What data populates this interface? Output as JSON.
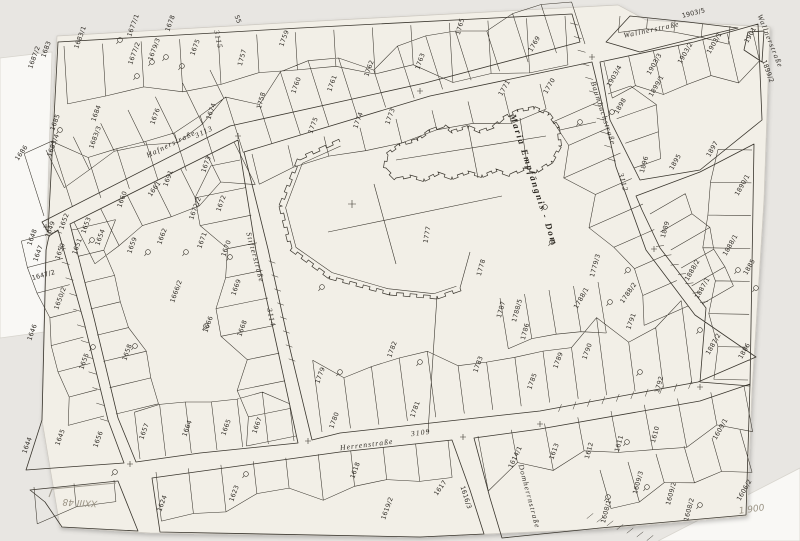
{
  "map": {
    "title": "Katastralmappe – Maria Empfängnis - Dom",
    "dom_label": "Maria Empfängnis - Dom",
    "ink_color": "#3a362e",
    "paper_color": "#f2efe7",
    "backdrop_color": "#e8e6e2",
    "under_sheet_color": "#f9f8f5",
    "streets": [
      {
        "t": "Hafnerstraße",
        "x": 172,
        "y": 146,
        "r": -26
      },
      {
        "t": "3113",
        "x": 205,
        "y": 134,
        "r": -26
      },
      {
        "t": "Stifterstraße",
        "x": 253,
        "y": 258,
        "r": 75
      },
      {
        "t": "3114",
        "x": 269,
        "y": 318,
        "r": 77
      },
      {
        "t": "Herrenstraße",
        "x": 367,
        "y": 447,
        "r": -7
      },
      {
        "t": "3109",
        "x": 421,
        "y": 435,
        "r": -7
      },
      {
        "t": "Baumbachstraße",
        "x": 601,
        "y": 114,
        "r": 72
      },
      {
        "t": "Wallnerstraße",
        "x": 652,
        "y": 32,
        "r": -12
      },
      {
        "t": "Wallnerstraße",
        "x": 768,
        "y": 42,
        "r": 68
      },
      {
        "t": "3112",
        "x": 621,
        "y": 183,
        "r": 74
      },
      {
        "t": "3115",
        "x": 216,
        "y": 40,
        "r": 78
      },
      {
        "t": "Domherrnstraße",
        "x": 527,
        "y": 497,
        "r": 75
      }
    ],
    "parcels": [
      {
        "t": "1687/2",
        "x": 36,
        "y": 58,
        "r": -70
      },
      {
        "t": "1683",
        "x": 48,
        "y": 50,
        "r": -70
      },
      {
        "t": "1683/1",
        "x": 82,
        "y": 38,
        "r": -70
      },
      {
        "t": "1677/1",
        "x": 135,
        "y": 26,
        "r": -70
      },
      {
        "t": "1677/2",
        "x": 136,
        "y": 54,
        "r": -70
      },
      {
        "t": "1679/3",
        "x": 156,
        "y": 50,
        "r": -70
      },
      {
        "t": "1678",
        "x": 172,
        "y": 24,
        "r": -70
      },
      {
        "t": "1675",
        "x": 197,
        "y": 48,
        "r": -70
      },
      {
        "t": "1674",
        "x": 213,
        "y": 112,
        "r": -70
      },
      {
        "t": "1757",
        "x": 244,
        "y": 58,
        "r": -75
      },
      {
        "t": "1758",
        "x": 263,
        "y": 101,
        "r": -75
      },
      {
        "t": "1684",
        "x": 98,
        "y": 114,
        "r": -70
      },
      {
        "t": "1685",
        "x": 57,
        "y": 123,
        "r": -70
      },
      {
        "t": "1686",
        "x": 23,
        "y": 154,
        "r": -55
      },
      {
        "t": "1683/3",
        "x": 97,
        "y": 138,
        "r": -70
      },
      {
        "t": "1683/4",
        "x": 55,
        "y": 146,
        "r": -70
      },
      {
        "t": "1676",
        "x": 157,
        "y": 117,
        "r": -70
      },
      {
        "t": "55",
        "x": 236,
        "y": 20,
        "r": 70
      },
      {
        "t": "1759",
        "x": 286,
        "y": 39,
        "r": -70
      },
      {
        "t": "1760",
        "x": 298,
        "y": 86,
        "r": -70
      },
      {
        "t": "1761",
        "x": 334,
        "y": 84,
        "r": -70
      },
      {
        "t": "1762",
        "x": 371,
        "y": 69,
        "r": -70
      },
      {
        "t": "1763",
        "x": 422,
        "y": 62,
        "r": -70
      },
      {
        "t": "1765",
        "x": 462,
        "y": 27,
        "r": -75
      },
      {
        "t": "1769",
        "x": 536,
        "y": 45,
        "r": -60
      },
      {
        "t": "1770",
        "x": 551,
        "y": 87,
        "r": -60
      },
      {
        "t": "1771",
        "x": 506,
        "y": 89,
        "r": -60
      },
      {
        "t": "1773",
        "x": 392,
        "y": 117,
        "r": -70
      },
      {
        "t": "1774",
        "x": 360,
        "y": 121,
        "r": -70
      },
      {
        "t": "1775",
        "x": 315,
        "y": 126,
        "r": -70
      },
      {
        "t": "1777",
        "x": 429,
        "y": 235,
        "r": -80
      },
      {
        "t": "1778",
        "x": 483,
        "y": 268,
        "r": -75
      },
      {
        "t": "1779",
        "x": 322,
        "y": 376,
        "r": -70
      },
      {
        "t": "1780",
        "x": 336,
        "y": 421,
        "r": -70
      },
      {
        "t": "1781",
        "x": 417,
        "y": 410,
        "r": -70
      },
      {
        "t": "1782",
        "x": 394,
        "y": 350,
        "r": -70
      },
      {
        "t": "1783",
        "x": 480,
        "y": 365,
        "r": -70
      },
      {
        "t": "1785",
        "x": 534,
        "y": 382,
        "r": -70
      },
      {
        "t": "1786",
        "x": 527,
        "y": 332,
        "r": -75
      },
      {
        "t": "1787",
        "x": 503,
        "y": 310,
        "r": -75
      },
      {
        "t": "1788/5",
        "x": 519,
        "y": 311,
        "r": -75
      },
      {
        "t": "1788/1",
        "x": 583,
        "y": 299,
        "r": -60
      },
      {
        "t": "1789",
        "x": 560,
        "y": 361,
        "r": -70
      },
      {
        "t": "1790",
        "x": 589,
        "y": 352,
        "r": -70
      },
      {
        "t": "1791",
        "x": 633,
        "y": 322,
        "r": -70
      },
      {
        "t": "1788/2",
        "x": 630,
        "y": 294,
        "r": -55
      },
      {
        "t": "1779/3",
        "x": 597,
        "y": 266,
        "r": -75
      },
      {
        "t": "1792",
        "x": 661,
        "y": 385,
        "r": -75
      },
      {
        "t": "1673",
        "x": 208,
        "y": 165,
        "r": -70
      },
      {
        "t": "1691",
        "x": 170,
        "y": 179,
        "r": -70
      },
      {
        "t": "1661",
        "x": 156,
        "y": 190,
        "r": -55
      },
      {
        "t": "1660",
        "x": 124,
        "y": 200,
        "r": -70
      },
      {
        "t": "1648",
        "x": 34,
        "y": 238,
        "r": -70
      },
      {
        "t": "1649",
        "x": 52,
        "y": 230,
        "r": -70
      },
      {
        "t": "1652",
        "x": 66,
        "y": 222,
        "r": -70
      },
      {
        "t": "1653",
        "x": 88,
        "y": 226,
        "r": -70
      },
      {
        "t": "1650",
        "x": 62,
        "y": 252,
        "r": -70
      },
      {
        "t": "1651",
        "x": 79,
        "y": 247,
        "r": -70
      },
      {
        "t": "1654",
        "x": 102,
        "y": 238,
        "r": -70
      },
      {
        "t": "1659",
        "x": 134,
        "y": 246,
        "r": -70
      },
      {
        "t": "1662",
        "x": 164,
        "y": 237,
        "r": -70
      },
      {
        "t": "1672/2",
        "x": 197,
        "y": 209,
        "r": -70
      },
      {
        "t": "1672",
        "x": 223,
        "y": 204,
        "r": -70
      },
      {
        "t": "1671",
        "x": 204,
        "y": 241,
        "r": -70
      },
      {
        "t": "1670",
        "x": 228,
        "y": 249,
        "r": -70
      },
      {
        "t": "1669",
        "x": 238,
        "y": 288,
        "r": -70
      },
      {
        "t": "1666/2",
        "x": 178,
        "y": 292,
        "r": -70
      },
      {
        "t": "1666",
        "x": 210,
        "y": 325,
        "r": -70
      },
      {
        "t": "1668",
        "x": 244,
        "y": 329,
        "r": -70
      },
      {
        "t": "1647",
        "x": 40,
        "y": 254,
        "r": -70
      },
      {
        "t": "1647/2",
        "x": 44,
        "y": 277,
        "r": -15
      },
      {
        "t": "1650/2",
        "x": 62,
        "y": 299,
        "r": -70
      },
      {
        "t": "1646",
        "x": 34,
        "y": 333,
        "r": -70
      },
      {
        "t": "1655",
        "x": 86,
        "y": 362,
        "r": -70
      },
      {
        "t": "1658",
        "x": 129,
        "y": 353,
        "r": -70
      },
      {
        "t": "1644",
        "x": 29,
        "y": 446,
        "r": -70
      },
      {
        "t": "1645",
        "x": 62,
        "y": 438,
        "r": -70
      },
      {
        "t": "1656",
        "x": 100,
        "y": 440,
        "r": -70
      },
      {
        "t": "1657",
        "x": 146,
        "y": 432,
        "r": -70
      },
      {
        "t": "1664",
        "x": 189,
        "y": 429,
        "r": -70
      },
      {
        "t": "1665",
        "x": 228,
        "y": 428,
        "r": -70
      },
      {
        "t": "1667",
        "x": 259,
        "y": 426,
        "r": -70
      },
      {
        "t": "1624",
        "x": 164,
        "y": 504,
        "r": -70
      },
      {
        "t": "1623",
        "x": 236,
        "y": 494,
        "r": -70
      },
      {
        "t": "1619/2",
        "x": 389,
        "y": 509,
        "r": -70
      },
      {
        "t": "1618",
        "x": 357,
        "y": 471,
        "r": -70
      },
      {
        "t": "1617",
        "x": 442,
        "y": 489,
        "r": -55
      },
      {
        "t": "1616/3",
        "x": 464,
        "y": 498,
        "r": 72
      },
      {
        "t": "1614/1",
        "x": 517,
        "y": 458,
        "r": -65
      },
      {
        "t": "1613",
        "x": 556,
        "y": 452,
        "r": -70
      },
      {
        "t": "1610",
        "x": 657,
        "y": 435,
        "r": -75
      },
      {
        "t": "1611",
        "x": 621,
        "y": 444,
        "r": -75
      },
      {
        "t": "1612",
        "x": 591,
        "y": 451,
        "r": -75
      },
      {
        "t": "1609/1",
        "x": 722,
        "y": 430,
        "r": -60
      },
      {
        "t": "1609/3",
        "x": 640,
        "y": 483,
        "r": -75
      },
      {
        "t": "1609/2",
        "x": 673,
        "y": 494,
        "r": -75
      },
      {
        "t": "1608/2",
        "x": 691,
        "y": 510,
        "r": -75
      },
      {
        "t": "1608/1",
        "x": 608,
        "y": 512,
        "r": -75
      },
      {
        "t": "1606/2",
        "x": 746,
        "y": 491,
        "r": -60
      },
      {
        "t": "1889",
        "x": 667,
        "y": 230,
        "r": -75
      },
      {
        "t": "1890/1",
        "x": 744,
        "y": 186,
        "r": -60
      },
      {
        "t": "1888/1",
        "x": 732,
        "y": 246,
        "r": -60
      },
      {
        "t": "1888/2",
        "x": 694,
        "y": 271,
        "r": -60
      },
      {
        "t": "1885",
        "x": 751,
        "y": 268,
        "r": -60
      },
      {
        "t": "1887/1",
        "x": 704,
        "y": 289,
        "r": -60
      },
      {
        "t": "1887/2",
        "x": 715,
        "y": 345,
        "r": -60
      },
      {
        "t": "1886",
        "x": 746,
        "y": 352,
        "r": -60
      },
      {
        "t": "1895",
        "x": 677,
        "y": 163,
        "r": -60
      },
      {
        "t": "1896",
        "x": 646,
        "y": 165,
        "r": -75
      },
      {
        "t": "1897",
        "x": 714,
        "y": 150,
        "r": -60
      },
      {
        "t": "1898",
        "x": 622,
        "y": 107,
        "r": -60
      },
      {
        "t": "1899/1",
        "x": 658,
        "y": 87,
        "r": -60
      },
      {
        "t": "1899/2",
        "x": 766,
        "y": 72,
        "r": 70
      },
      {
        "t": "1901",
        "x": 752,
        "y": 36,
        "r": -60
      },
      {
        "t": "1903/1",
        "x": 716,
        "y": 44,
        "r": -60
      },
      {
        "t": "1903/2",
        "x": 687,
        "y": 54,
        "r": -60
      },
      {
        "t": "1903/3",
        "x": 656,
        "y": 65,
        "r": -60
      },
      {
        "t": "1903/4",
        "x": 616,
        "y": 77,
        "r": -60
      },
      {
        "t": "1903/5",
        "x": 694,
        "y": 15,
        "r": -14
      }
    ],
    "pencil_notes": [
      {
        "t": "XXIII 48",
        "x": 80,
        "y": 500,
        "r": 183,
        "s": 10
      },
      {
        "t": "1 900",
        "x": 752,
        "y": 512,
        "r": -8,
        "s": 7
      }
    ],
    "symbols": [
      [
        120,
        40
      ],
      [
        152,
        62
      ],
      [
        166,
        57
      ],
      [
        182,
        66
      ],
      [
        137,
        76
      ],
      [
        60,
        130
      ],
      [
        92,
        240
      ],
      [
        148,
        252
      ],
      [
        186,
        252
      ],
      [
        206,
        326
      ],
      [
        230,
        257
      ],
      [
        322,
        287
      ],
      [
        340,
        372
      ],
      [
        420,
        362
      ],
      [
        545,
        207
      ],
      [
        552,
        242
      ],
      [
        610,
        302
      ],
      [
        628,
        270
      ],
      [
        738,
        270
      ],
      [
        700,
        330
      ],
      [
        640,
        372
      ],
      [
        627,
        442
      ],
      [
        647,
        487
      ],
      [
        608,
        497
      ],
      [
        93,
        347
      ],
      [
        135,
        346
      ],
      [
        115,
        472
      ],
      [
        246,
        474
      ],
      [
        580,
        122
      ],
      [
        612,
        112
      ],
      [
        700,
        505
      ],
      [
        756,
        288
      ]
    ]
  }
}
